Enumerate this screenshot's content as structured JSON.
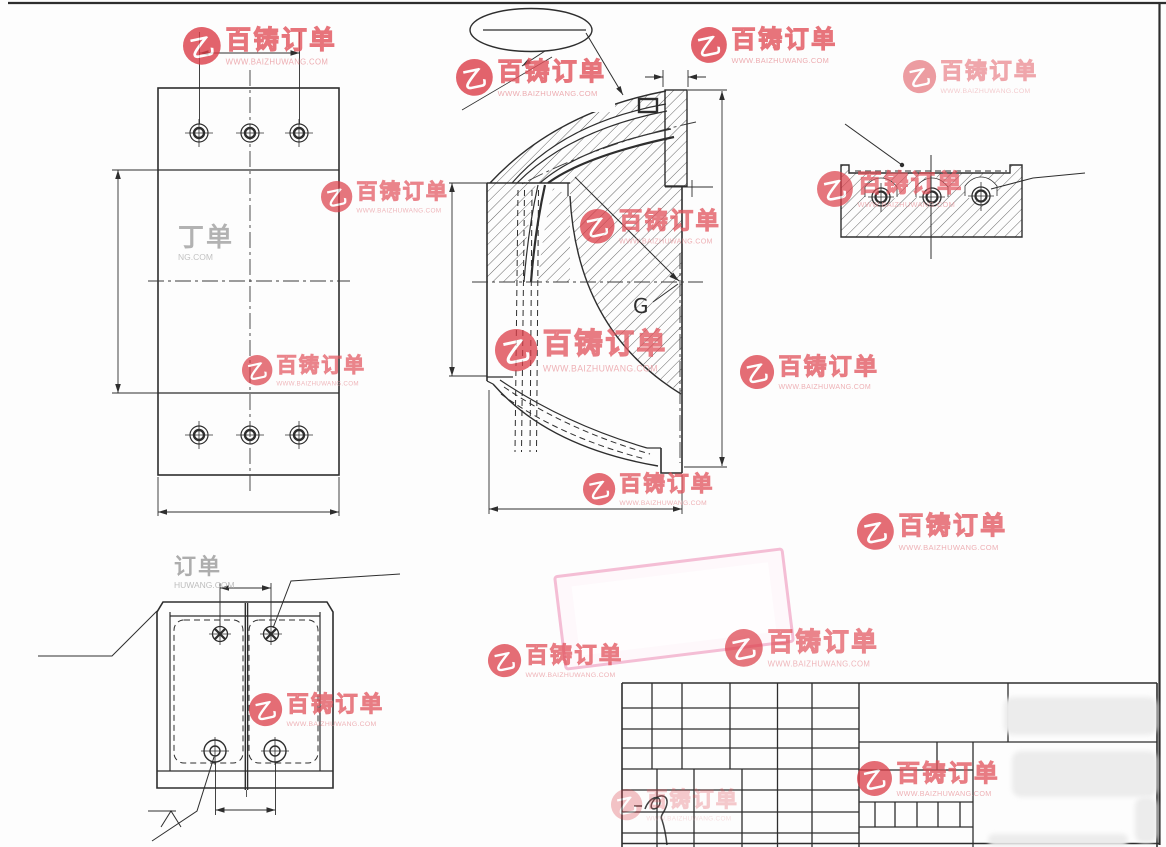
{
  "watermark": {
    "brand": "百铸订单",
    "url": "WWW.BAIZHUWANG.COM",
    "logo_glyph": "乙",
    "brand_color": "#e2525b",
    "url_color": "#e9989e"
  },
  "labels": {
    "section_center_label": "G"
  },
  "partial_watermarks": [
    {
      "text": "丁单",
      "sub": "NG.COM"
    },
    {
      "text": "订单",
      "sub": "HUWANG.COM"
    }
  ],
  "colors": {
    "accent_red": "#dc3d48",
    "stamp_pink": "#f4bed5",
    "line": "#2e2e2e",
    "background": "#fdfdfd"
  }
}
